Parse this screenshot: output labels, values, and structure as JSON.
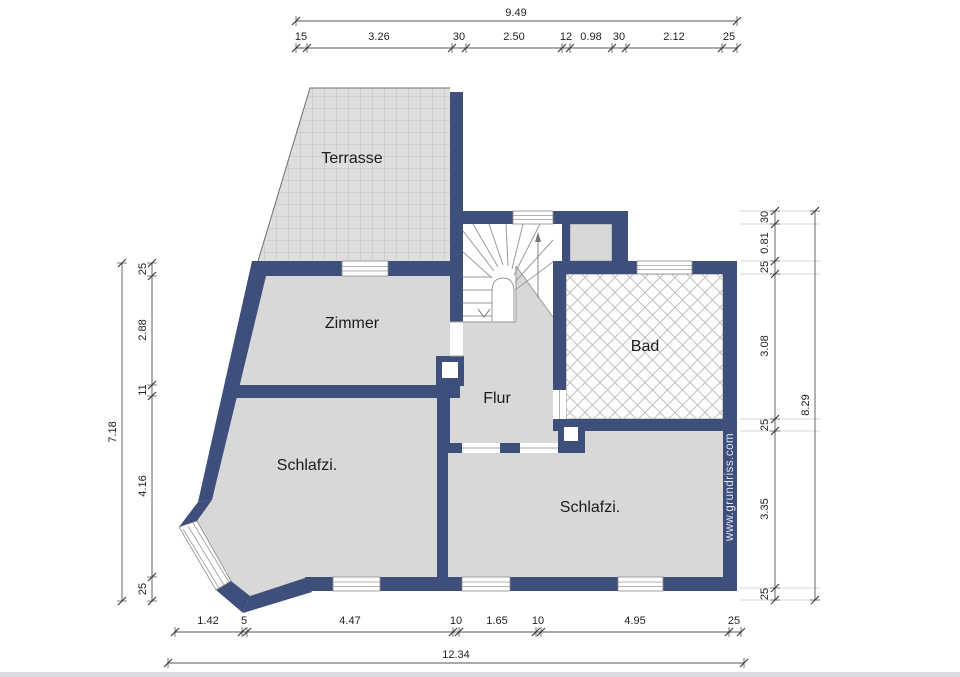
{
  "plan": {
    "rooms": {
      "terrasse": "Terrasse",
      "zimmer": "Zimmer",
      "bad": "Bad",
      "flur": "Flur",
      "schlafzimmer_left": "Schlafzi.",
      "schlafzimmer_right": "Schlafzi."
    },
    "watermark": "www.grundriss.com"
  },
  "dimensions": {
    "top": {
      "total": "9.49",
      "chain": [
        "15",
        "3.26",
        "30",
        "2.50",
        "12",
        "0.98",
        "30",
        "2.12",
        "25"
      ]
    },
    "bottom": {
      "total": "12.34",
      "chain": [
        "1.42",
        "5",
        "4.47",
        "10",
        "1.65",
        "10",
        "4.95",
        "25"
      ]
    },
    "left": {
      "total": "7.18",
      "chain": [
        "25",
        "2.88",
        "11",
        "4.16",
        "25"
      ]
    },
    "right": {
      "total": "8.29",
      "chain": [
        "30",
        "0.81",
        "25",
        "3.08",
        "25",
        "3.35",
        "25"
      ]
    }
  },
  "colors": {
    "wall": "#3f4f7b",
    "floor": "#d8d8d8",
    "terrace_tile": "#dedede",
    "bad_lattice": "#b5b5b5",
    "dimension_text": "#222222",
    "watermark_text": "#dfe3ef"
  }
}
